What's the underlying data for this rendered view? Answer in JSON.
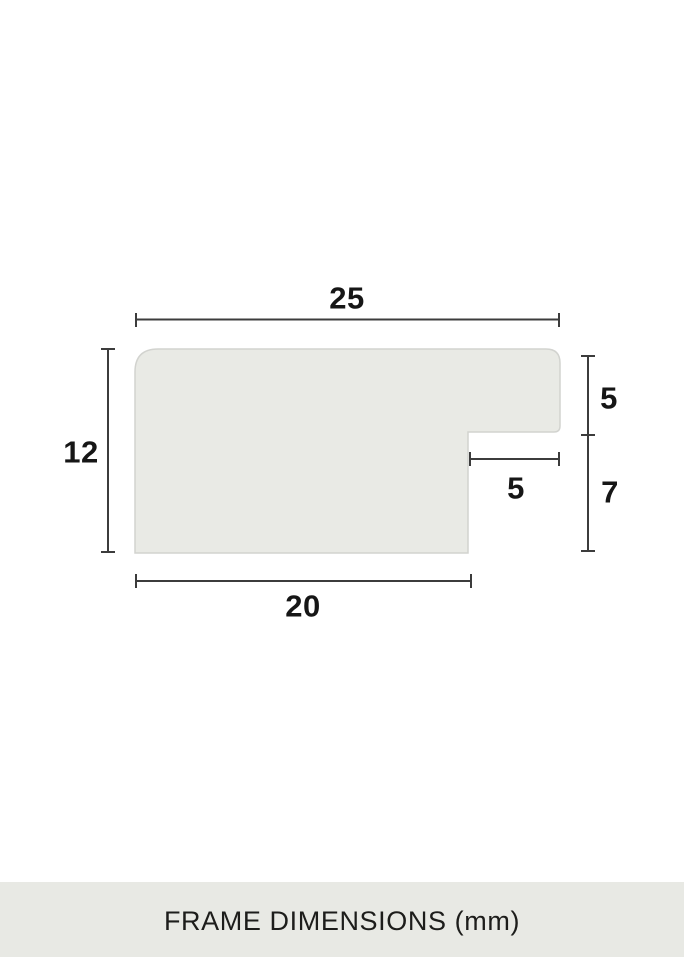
{
  "diagram": {
    "title": "frame-profile-cross-section",
    "dimensions": {
      "top_width": "25",
      "left_height": "12",
      "right_upper_height": "5",
      "right_lower_height": "7",
      "rabbet_width": "5",
      "bottom_width": "20"
    },
    "colors": {
      "profile_fill": "#e9eae5",
      "profile_stroke": "#d2d3cf",
      "dimension_line": "#3c3c3c",
      "label_text": "#161616"
    }
  },
  "caption": {
    "label": "FRAME DIMENSIONS (mm)",
    "background": "#e8e9e4",
    "text_color": "#1d1d1b"
  }
}
